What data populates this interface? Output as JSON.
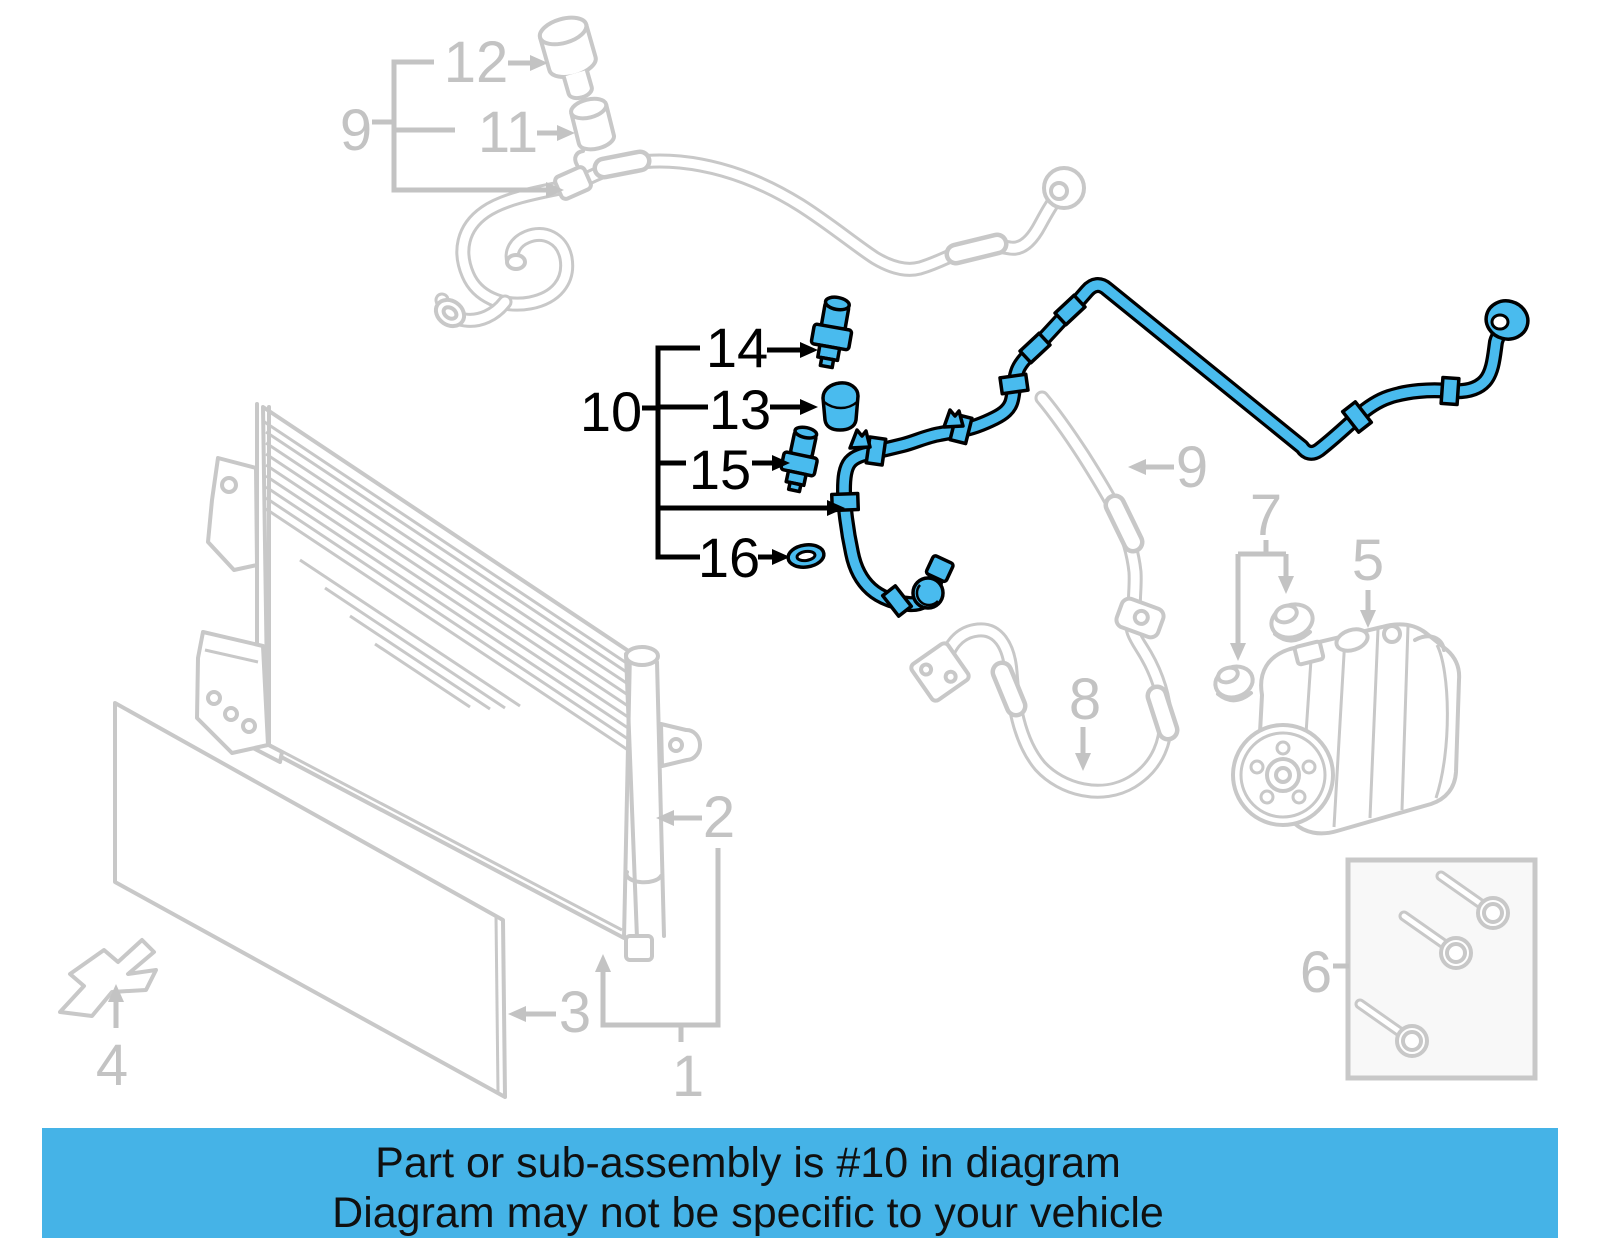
{
  "banner": {
    "line1": "Part or sub-assembly is #10 in diagram",
    "line2": "Diagram may not be specific to your vehicle",
    "bg": "#45b3e7",
    "fg": "#101010"
  },
  "diagram": {
    "highlighted_part_number": "10",
    "colors": {
      "highlight": "#49bbee",
      "outline": "#000000",
      "linework": "#c8c8c8",
      "label_gray": "#c3c3c3"
    },
    "callouts": {
      "p1": {
        "label": "1"
      },
      "p2": {
        "label": "2"
      },
      "p3": {
        "label": "3"
      },
      "p4": {
        "label": "4"
      },
      "p5": {
        "label": "5"
      },
      "p6": {
        "label": "6"
      },
      "p7": {
        "label": "7"
      },
      "p8": {
        "label": "8"
      },
      "p9a": {
        "label": "9"
      },
      "p9b": {
        "label": "9"
      },
      "p10": {
        "label": "10"
      },
      "p11": {
        "label": "11"
      },
      "p12": {
        "label": "12"
      },
      "p13": {
        "label": "13"
      },
      "p14": {
        "label": "14"
      },
      "p15": {
        "label": "15"
      },
      "p16": {
        "label": "16"
      }
    }
  }
}
